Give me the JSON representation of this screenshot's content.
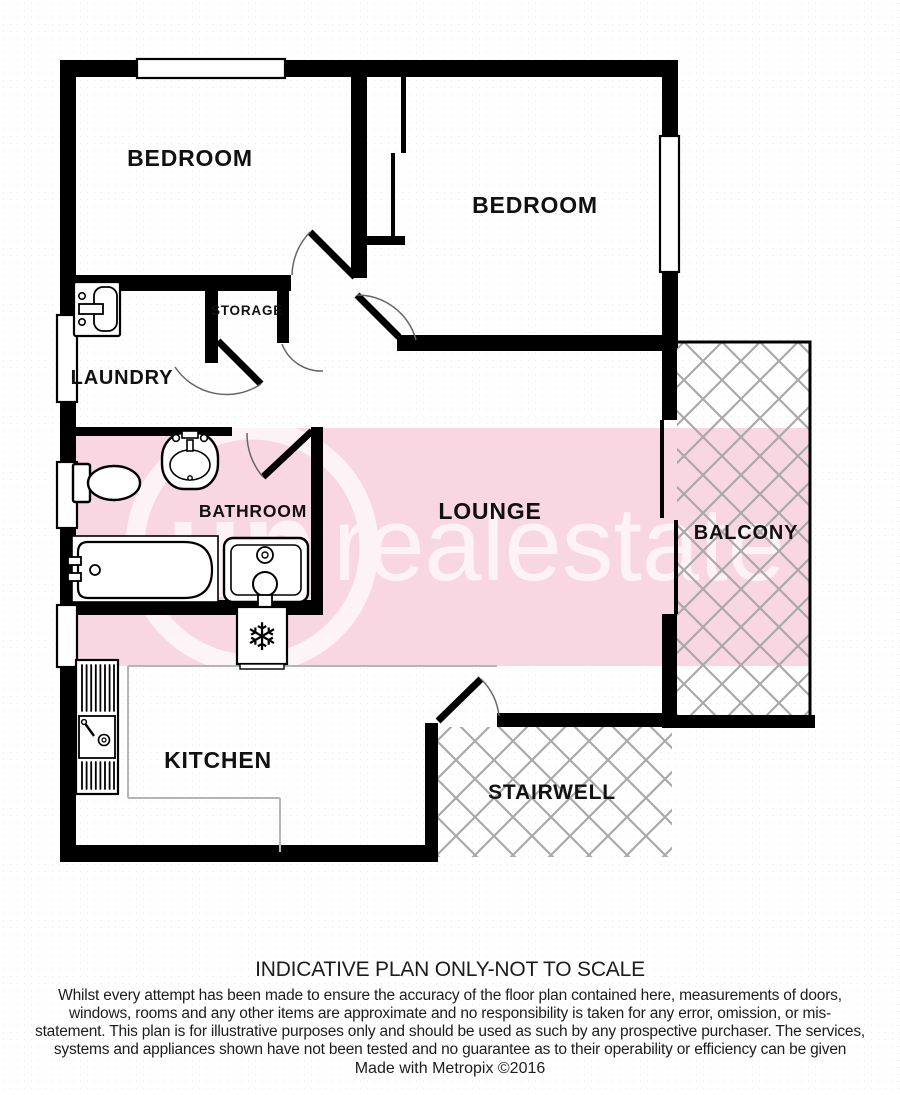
{
  "plan": {
    "rooms": {
      "bedroom_left": "BEDROOM",
      "bedroom_right": "BEDROOM",
      "storage": "STORAGE",
      "laundry": "LAUNDRY",
      "bathroom": "BATHROOM",
      "lounge": "LOUNGE",
      "balcony": "BALCONY",
      "kitchen": "KITCHEN",
      "stairwell": "STAIRWELL"
    },
    "watermark": {
      "circle_text": "un",
      "brand_text": "realestate"
    },
    "icons": {
      "fridge_snowflake": "❄"
    },
    "colors": {
      "wall": "#000000",
      "band_pink": "#f8d7e2",
      "hatch_gray": "#a9a9a9",
      "watermark_white": "#ffffff",
      "worktop_gray": "#b5b5b5"
    }
  },
  "footer": {
    "title": "INDICATIVE PLAN ONLY-NOT TO SCALE",
    "disclaimer": "Whilst every attempt has been made to ensure the accuracy of the floor plan contained here, measurements of doors, windows, rooms and any other items are approximate and no responsibility is taken for any error, omission, or mis-statement. This plan is for illustrative purposes only and should be used as such by any prospective purchaser. The services, systems and appliances shown have not been tested and no guarantee as to their operability or efficiency can be given",
    "credit": "Made with Metropix ©2016"
  }
}
